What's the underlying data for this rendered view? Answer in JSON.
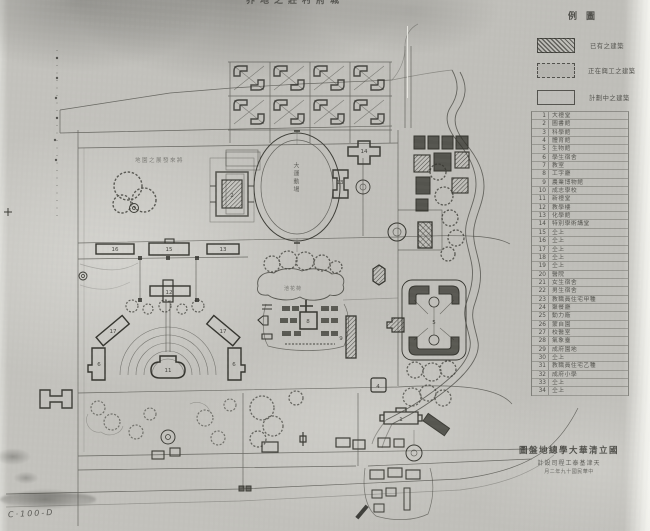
{
  "photo": {
    "catalog_number": "C·100-D",
    "top_edge_label": "界地之莊村府城"
  },
  "legend": {
    "title": "例圖",
    "swatches": [
      {
        "style": "hatched",
        "label": "已有之建築"
      },
      {
        "style": "dashed",
        "label": "正在興工之建築"
      },
      {
        "style": "outline",
        "label": "計劃中之建築"
      }
    ],
    "items": [
      {
        "no": "1",
        "name": "大禮堂"
      },
      {
        "no": "2",
        "name": "圖書館"
      },
      {
        "no": "3",
        "name": "科學館"
      },
      {
        "no": "4",
        "name": "體育館"
      },
      {
        "no": "5",
        "name": "生物館"
      },
      {
        "no": "6",
        "name": "學生宿舍"
      },
      {
        "no": "7",
        "name": "教室"
      },
      {
        "no": "8",
        "name": "工字廳"
      },
      {
        "no": "9",
        "name": "農業博物館"
      },
      {
        "no": "10",
        "name": "成志學校"
      },
      {
        "no": "11",
        "name": "新禮堂"
      },
      {
        "no": "12",
        "name": "教學樓"
      },
      {
        "no": "13",
        "name": "化學館"
      },
      {
        "no": "14",
        "name": "特別學術講堂"
      },
      {
        "no": "15",
        "name": "仝上"
      },
      {
        "no": "16",
        "name": "仝上"
      },
      {
        "no": "17",
        "name": "仝上"
      },
      {
        "no": "18",
        "name": "仝上"
      },
      {
        "no": "19",
        "name": "仝上"
      },
      {
        "no": "20",
        "name": "醫院"
      },
      {
        "no": "21",
        "name": "女生宿舍"
      },
      {
        "no": "22",
        "name": "男生宿舍"
      },
      {
        "no": "23",
        "name": "教職員住宅甲種"
      },
      {
        "no": "24",
        "name": "聚餐廳"
      },
      {
        "no": "25",
        "name": "動力廠"
      },
      {
        "no": "26",
        "name": "蒙自園"
      },
      {
        "no": "27",
        "name": "校醫室"
      },
      {
        "no": "28",
        "name": "氣象臺"
      },
      {
        "no": "29",
        "name": "成府園地"
      },
      {
        "no": "30",
        "name": "仝上"
      },
      {
        "no": "31",
        "name": "教職員住宅乙種"
      },
      {
        "no": "32",
        "name": "成府小學"
      },
      {
        "no": "33",
        "name": "仝上"
      },
      {
        "no": "34",
        "name": "仝上"
      }
    ]
  },
  "title_block": {
    "line1": "圖盤地總學大華清立國",
    "line2": "計設司程工泰基津天",
    "line3": "月二年九十國民華中"
  },
  "map": {
    "oval_label": "大運動場",
    "pond_label": "池花荷",
    "west_area_label": "地園之展發來將",
    "numbers": [
      {
        "t": "14"
      },
      {
        "t": "13"
      },
      {
        "t": "2"
      },
      {
        "t": "16"
      },
      {
        "t": "15"
      },
      {
        "t": "13"
      },
      {
        "t": "12"
      },
      {
        "t": "17"
      },
      {
        "t": "17"
      },
      {
        "t": "6"
      },
      {
        "t": "6"
      },
      {
        "t": "11"
      },
      {
        "t": "8"
      },
      {
        "t": "9"
      },
      {
        "t": "4"
      },
      {
        "t": "5"
      },
      {
        "t": "1"
      }
    ]
  }
}
